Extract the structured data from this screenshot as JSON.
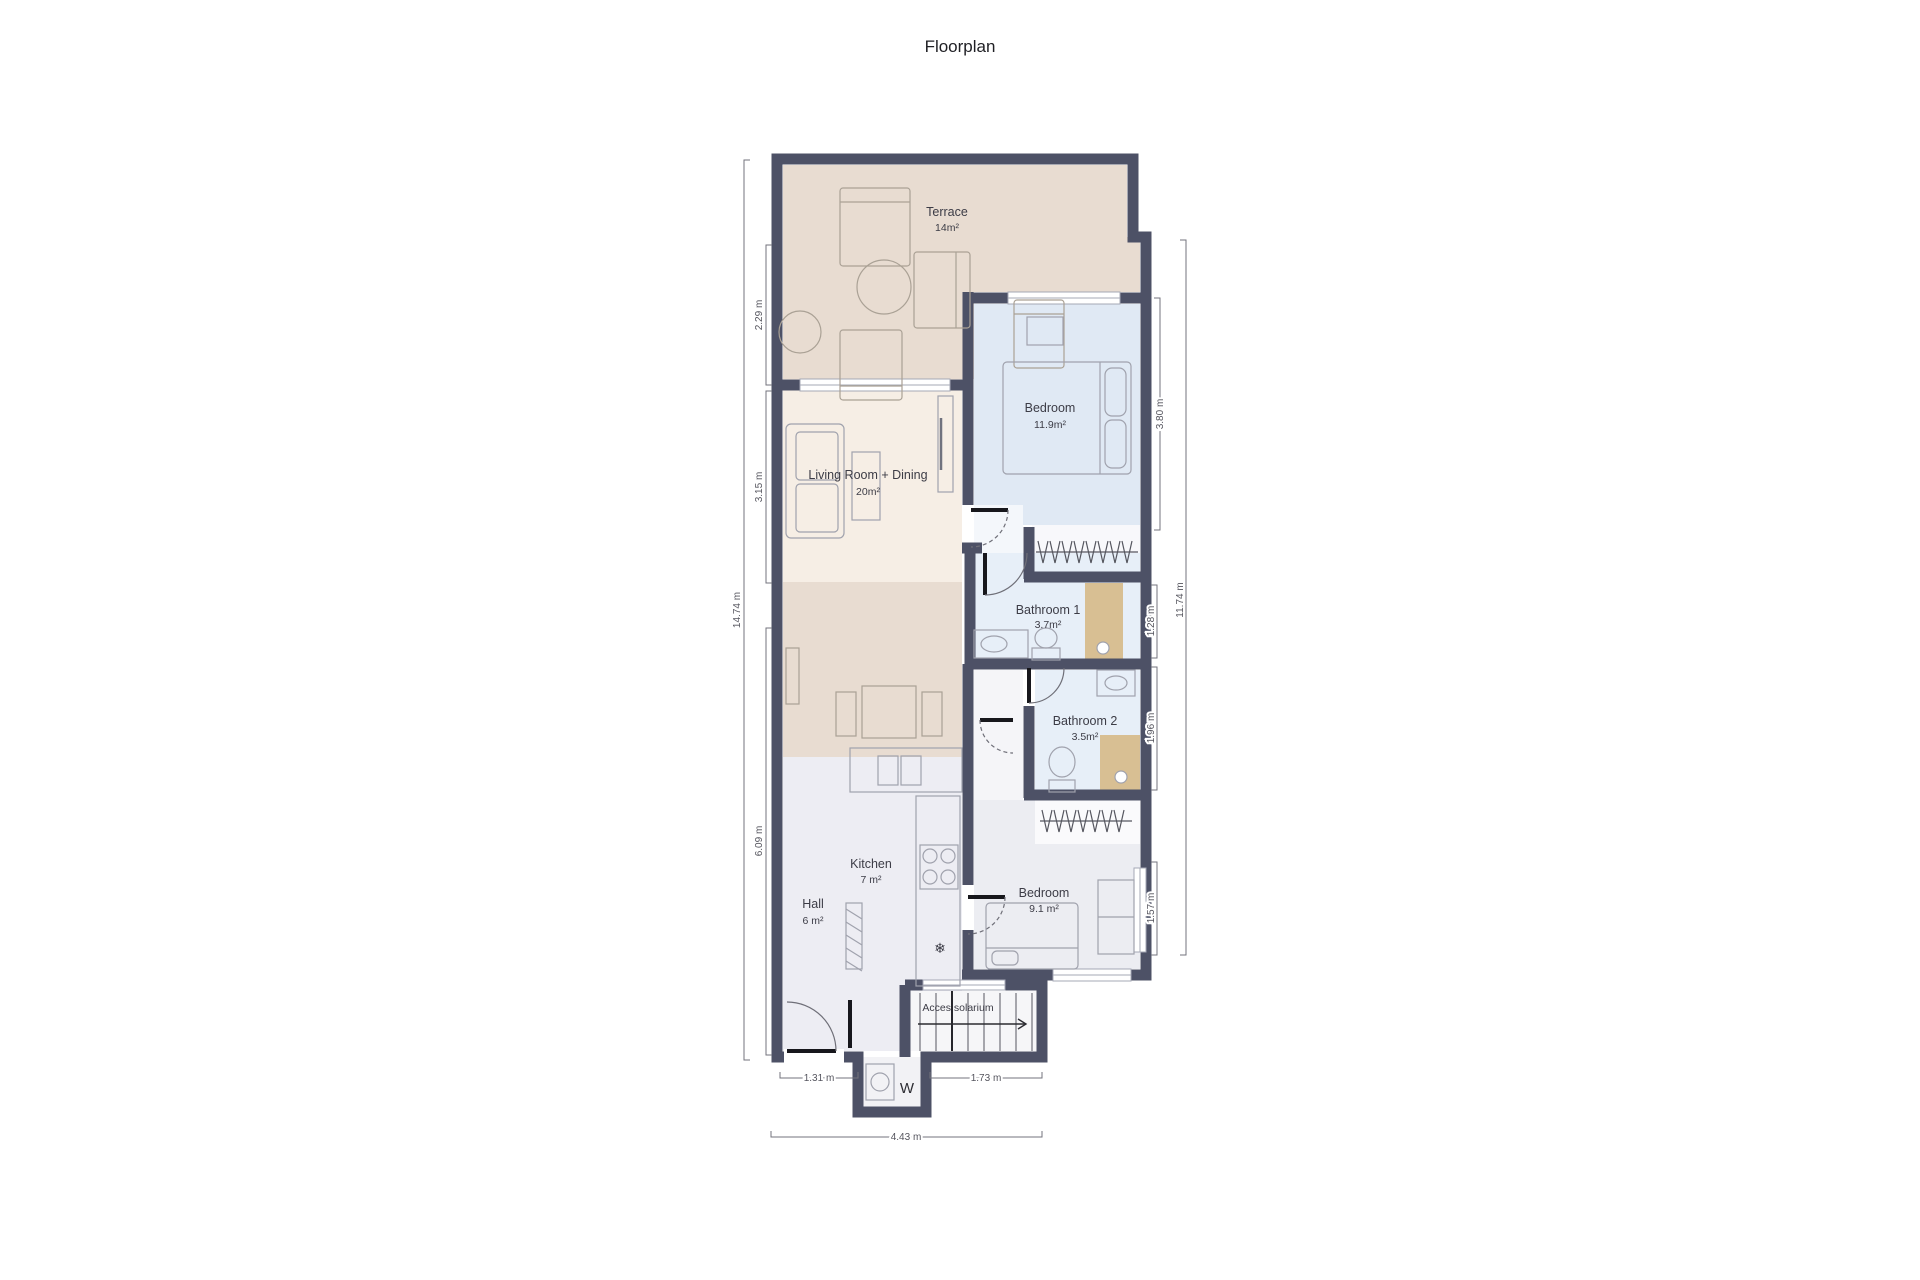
{
  "title": "Floorplan",
  "rooms": {
    "terrace": {
      "name": "Terrace",
      "area": "14m²"
    },
    "living": {
      "name": "Living Room + Dining",
      "area": "20m²"
    },
    "bedroom1": {
      "name": "Bedroom",
      "area": "11.9m²"
    },
    "bathroom1": {
      "name": "Bathroom 1",
      "area": "3.7m²"
    },
    "bathroom2": {
      "name": "Bathroom 2",
      "area": "3.5m²"
    },
    "kitchen": {
      "name": "Kitchen",
      "area": "7 m²"
    },
    "hall": {
      "name": "Hall",
      "area": "6 m²"
    },
    "bedroom2": {
      "name": "Bedroom",
      "area": "9.1 m²"
    },
    "stairs": {
      "name": "Acces solarium"
    },
    "washer": {
      "name": "W"
    }
  },
  "dimensions": {
    "left": [
      "2.29 m",
      "3.15 m",
      "6.09 m",
      "14.74 m"
    ],
    "right": [
      "3.80 m",
      "1.28 m",
      "1.96 m",
      "1.57 m",
      "11.74 m"
    ],
    "bottom": [
      "1.31 m",
      "1.73 m",
      "4.43 m"
    ]
  },
  "colors": {
    "wall": "#4d5166",
    "terrace_fill": "#e8dcd1",
    "living_fill": "#f6eee5",
    "bedroom1_fill": "#e0e9f4",
    "bathroom_fill": "#e7eff8",
    "shower_fill": "#d8bf93",
    "kitchen_fill": "#ededf3",
    "bedroom2_fill": "#ecedf2",
    "dim_line": "#73737c"
  }
}
